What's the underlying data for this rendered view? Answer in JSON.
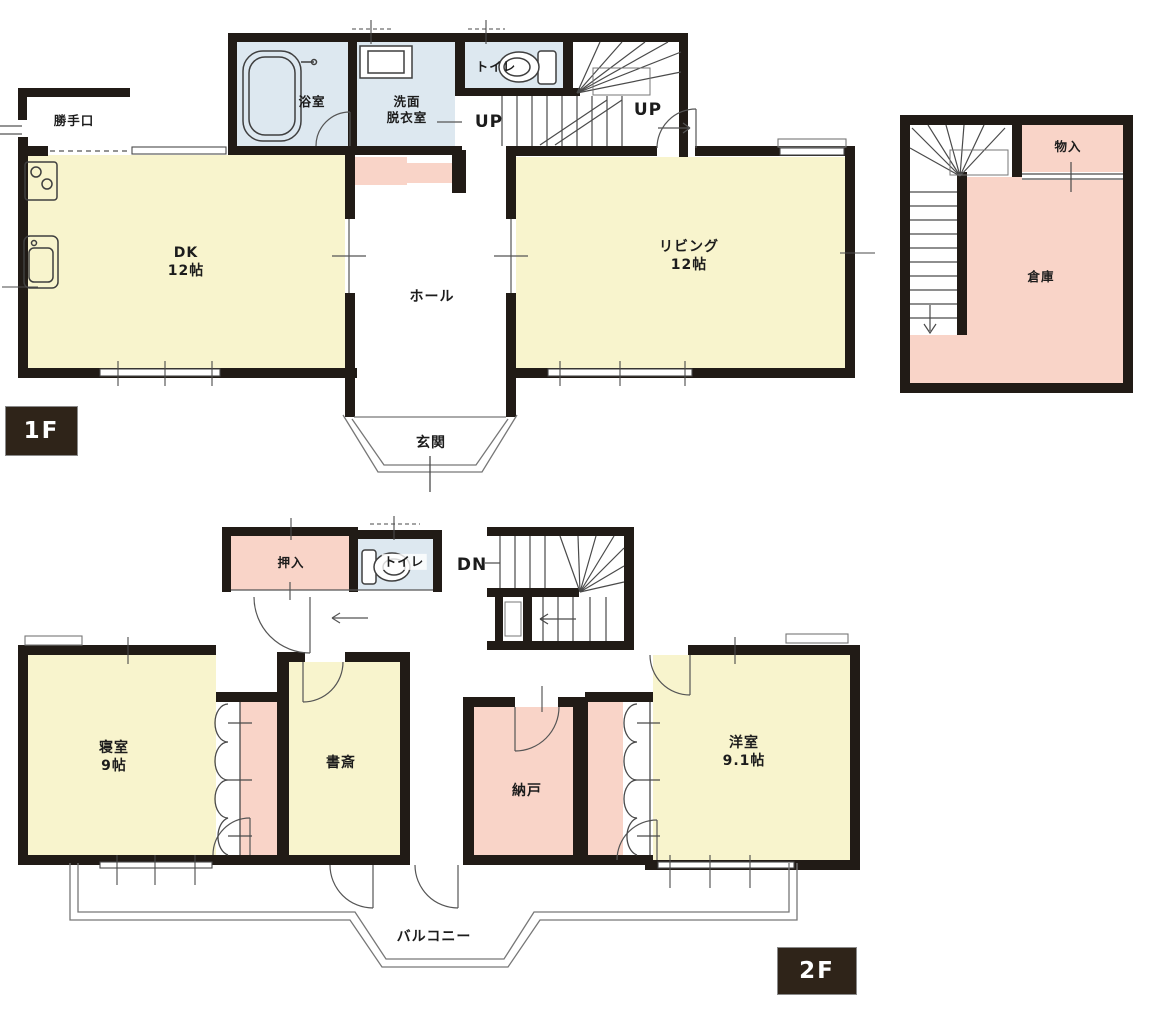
{
  "colors": {
    "wall": "#211b16",
    "room_yellow": "#f8f4cd",
    "room_pink": "#f9d4c8",
    "room_blue": "#dde8f0",
    "badge_bg": "#2f2419",
    "badge_text": "#ffffff",
    "line": "#4a4a4a"
  },
  "floor1": {
    "badge": "1F",
    "backdoor": "勝手口",
    "bath": "浴室",
    "washroom_line1": "洗面",
    "washroom_line2": "脱衣室",
    "toilet": "トイレ",
    "up_left": "UP",
    "up_right": "UP",
    "dk_name": "DK",
    "dk_size": "12帖",
    "hall": "ホール",
    "living_name": "リビング",
    "living_size": "12帖",
    "entrance": "玄関"
  },
  "annex": {
    "storage": "物入",
    "warehouse": "倉庫"
  },
  "floor2": {
    "badge": "2F",
    "oshiire": "押入",
    "toilet": "トイレ",
    "down": "DN",
    "bedroom_name": "寝室",
    "bedroom_size": "9帖",
    "study": "書斎",
    "nando": "納戸",
    "western_name": "洋室",
    "western_size": "9.1帖",
    "balcony": "バルコニー"
  }
}
